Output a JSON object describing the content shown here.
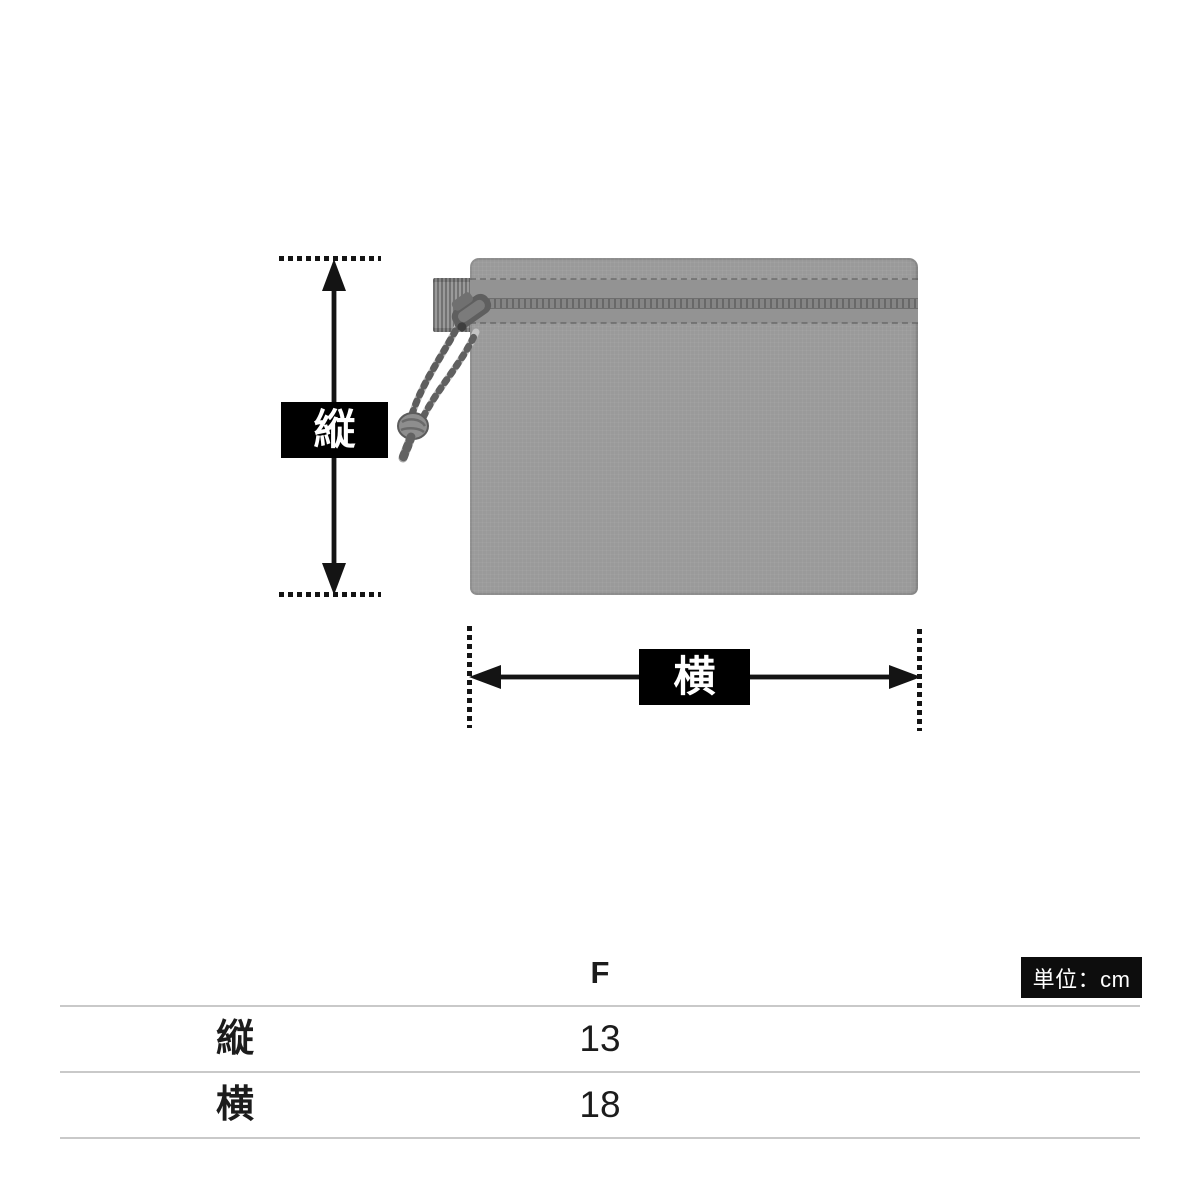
{
  "diagram": {
    "height_label": "縦",
    "width_label": "横",
    "pouch_color": "#9a9a9a",
    "zipper_band_color": "#858585",
    "arrow_color": "#141414",
    "label_bg": "#000000",
    "label_text_color": "#ffffff"
  },
  "size_table": {
    "column_header": "F",
    "unit_badge": "単位：cm",
    "rows": [
      {
        "label": "縦",
        "value": "13"
      },
      {
        "label": "横",
        "value": "18"
      }
    ],
    "line_color": "#c9c9c9"
  },
  "chart_data": {
    "type": "table",
    "columns": [
      "",
      "F"
    ],
    "rows": [
      [
        "縦",
        13
      ],
      [
        "横",
        18
      ]
    ],
    "unit": "cm"
  }
}
